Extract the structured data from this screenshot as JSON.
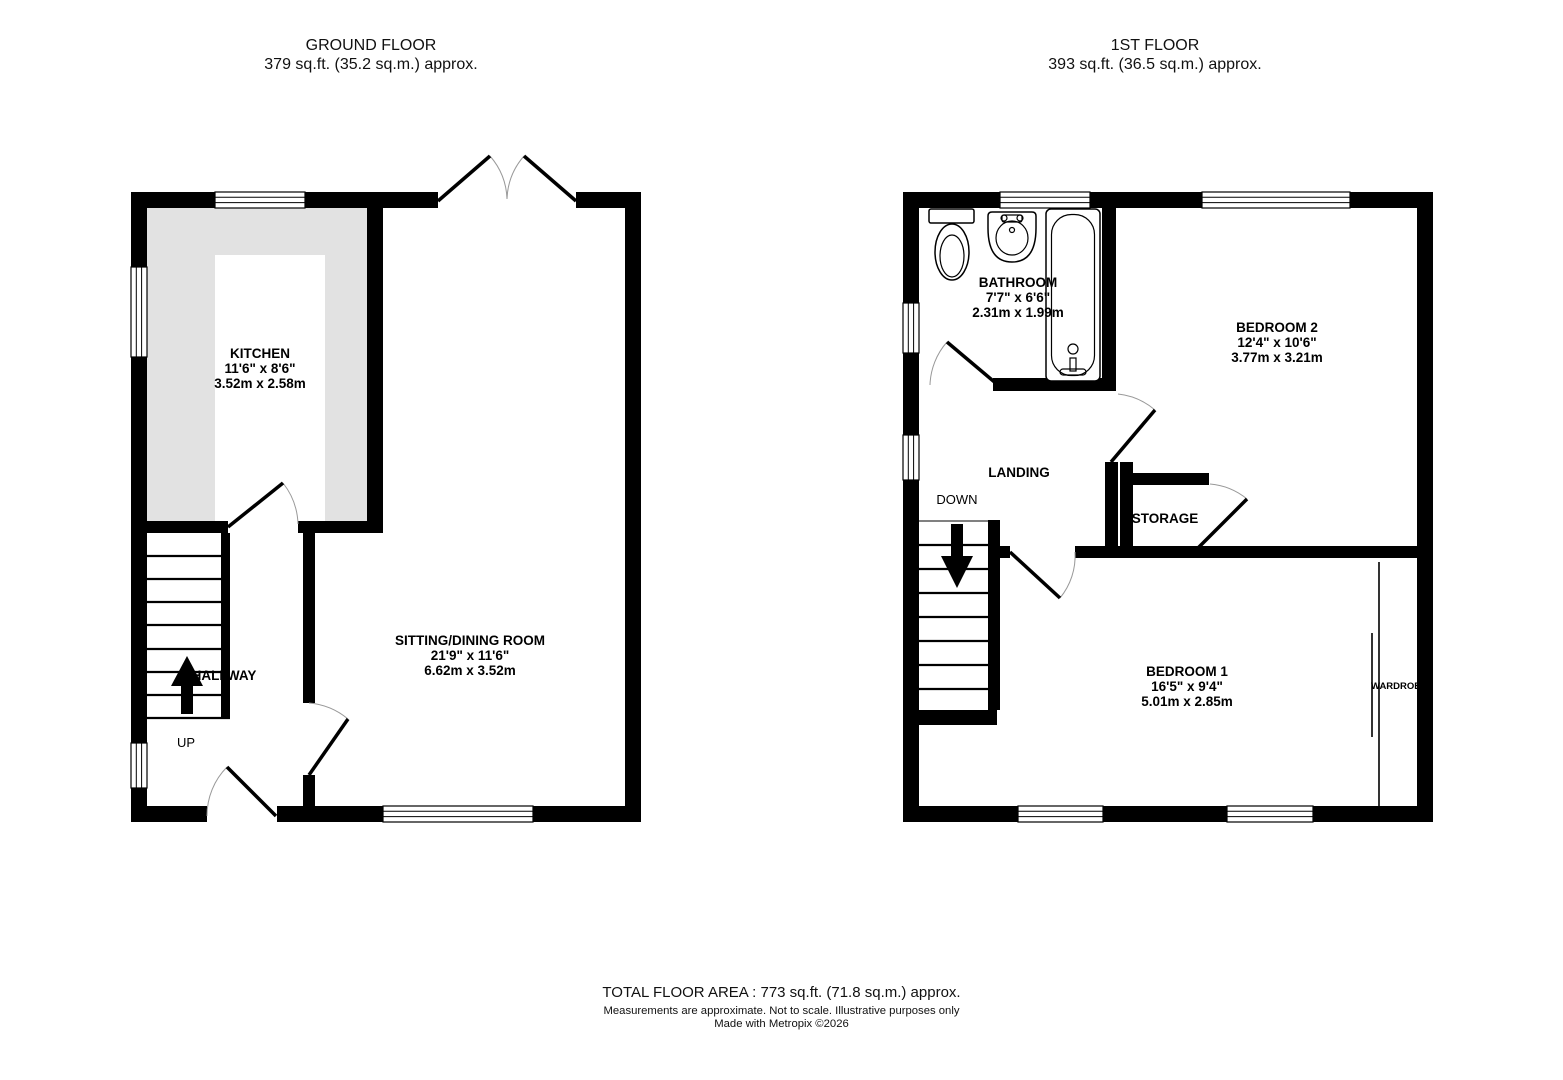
{
  "ground_floor": {
    "title": "GROUND FLOOR",
    "area": "379 sq.ft. (35.2 sq.m.) approx.",
    "rooms": {
      "kitchen": {
        "name": "KITCHEN",
        "imperial": "11'6\"  x 8'6\"",
        "metric": "3.52m  x 2.58m"
      },
      "sitting_dining": {
        "name": "SITTING/DINING ROOM",
        "imperial": "21'9\"  x 11'6\"",
        "metric": "6.62m  x 3.52m"
      },
      "hallway": {
        "name": "HALLWAY"
      }
    },
    "stairs": {
      "direction_label": "UP"
    }
  },
  "first_floor": {
    "title": "1ST FLOOR",
    "area": "393 sq.ft. (36.5 sq.m.) approx.",
    "rooms": {
      "bathroom": {
        "name": "BATHROOM",
        "imperial": "7'7\"  x 6'6\"",
        "metric": "2.31m  x 1.99m"
      },
      "bedroom2": {
        "name": "BEDROOM 2",
        "imperial": "12'4\"  x 10'6\"",
        "metric": "3.77m  x 3.21m"
      },
      "bedroom1": {
        "name": "BEDROOM 1",
        "imperial": "16'5\"  x 9'4\"",
        "metric": "5.01m  x 2.85m"
      },
      "landing": {
        "name": "LANDING"
      },
      "storage": {
        "name": "STORAGE"
      },
      "wardrobe": {
        "name": "WARDROBE"
      }
    },
    "stairs": {
      "direction_label": "DOWN"
    }
  },
  "footer": {
    "total_area": "TOTAL FLOOR AREA : 773 sq.ft. (71.8 sq.m.) approx.",
    "disclaimer": "Measurements are approximate.  Not to scale.  Illustrative purposes only",
    "credit": "Made with Metropix ©2026"
  }
}
